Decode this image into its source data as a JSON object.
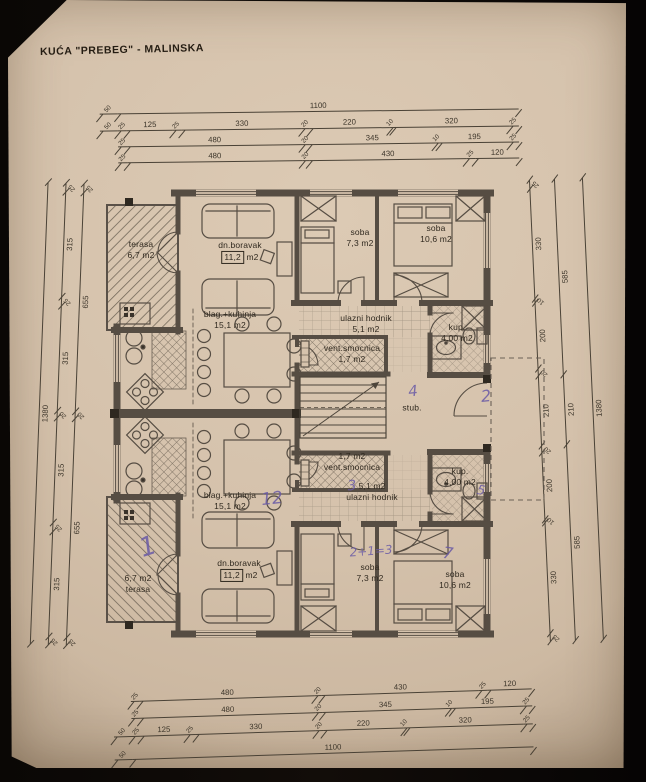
{
  "title": "KUĆA \"PREBEG\" - MALINSKA",
  "colors": {
    "paper": "#d5c2ac",
    "ink": "#4a4236",
    "wall": "#564d43",
    "pen": "#6a5ba6",
    "background": "#0a0705"
  },
  "dimensions": {
    "top_rows": [
      [
        50,
        1100
      ],
      [
        50,
        25,
        125,
        25,
        330,
        20,
        220,
        10,
        320,
        25
      ],
      [
        25,
        480,
        20,
        345,
        10,
        195,
        25
      ],
      [
        25,
        480,
        20,
        430,
        25,
        120
      ]
    ],
    "bottom_rows": [
      [
        25,
        480,
        20,
        430,
        25,
        120
      ],
      [
        25,
        480,
        20,
        345,
        10,
        195,
        25
      ],
      [
        50,
        25,
        125,
        25,
        330,
        20,
        220,
        10,
        320,
        25
      ],
      [
        50,
        1100
      ]
    ],
    "left_cols": [
      [
        1380
      ],
      [
        25,
        315,
        25,
        315,
        20,
        315,
        25,
        315,
        25
      ],
      [
        25,
        655,
        20,
        655,
        25
      ]
    ],
    "right_cols": [
      [
        25,
        330,
        10,
        200,
        20,
        210,
        20,
        200,
        10,
        330,
        25
      ],
      [
        585,
        210,
        585
      ],
      [
        1380
      ]
    ]
  },
  "rooms": {
    "upper": {
      "terasa": {
        "l1": "terasa",
        "l2": "6,7 m2"
      },
      "boravak": {
        "l1": "dn.boravak",
        "l2a": "11,2",
        "l2b": "m2"
      },
      "soba_small": {
        "l1": "soba",
        "l2": "7,3 m2"
      },
      "soba_big": {
        "l1": "soba",
        "l2": "10,6 m2"
      },
      "kuhinja": {
        "l1": "blag.+kuhinja",
        "l2": "15,1 m2"
      },
      "hodnik": {
        "l1": "ulazni hodnik",
        "l2": "5,1 m2"
      },
      "kup": {
        "l1": "kup.",
        "l2": "4,00 m2"
      },
      "smocnica": {
        "l1": "vent.smocnica",
        "l2": "1,7 m2"
      }
    },
    "lower": {
      "smocnica": {
        "l1": "1,7 m2",
        "l2": "vent.smocnica"
      },
      "hodnik": {
        "l1": "5,1 m2",
        "l2": "ulazni hodnik"
      },
      "kup": {
        "l1": "kup.",
        "l2": "4,00 m2"
      },
      "soba_small": {
        "l1": "soba",
        "l2": "7,3 m2"
      },
      "soba_big": {
        "l1": "soba",
        "l2": "10,6 m2"
      },
      "kuhinja": {
        "l1": "blag.+kuhinja",
        "l2": "15,1 m2"
      },
      "boravak": {
        "l1": "dn.boravak",
        "l2a": "11,2",
        "l2b": "m2"
      },
      "terasa": {
        "l1": "6,7 m2",
        "l2": "terasa"
      }
    },
    "stairs": {
      "label": "stub."
    }
  },
  "handwritten": {
    "terasa_mark": "1",
    "kuhinja_mark": "12",
    "hodnik_mark": "3",
    "soba_small_mark": "2+1=3",
    "soba_big_mark": "7",
    "stairs_mark": "4",
    "landing_mark": "2",
    "kup_mark": "5"
  }
}
